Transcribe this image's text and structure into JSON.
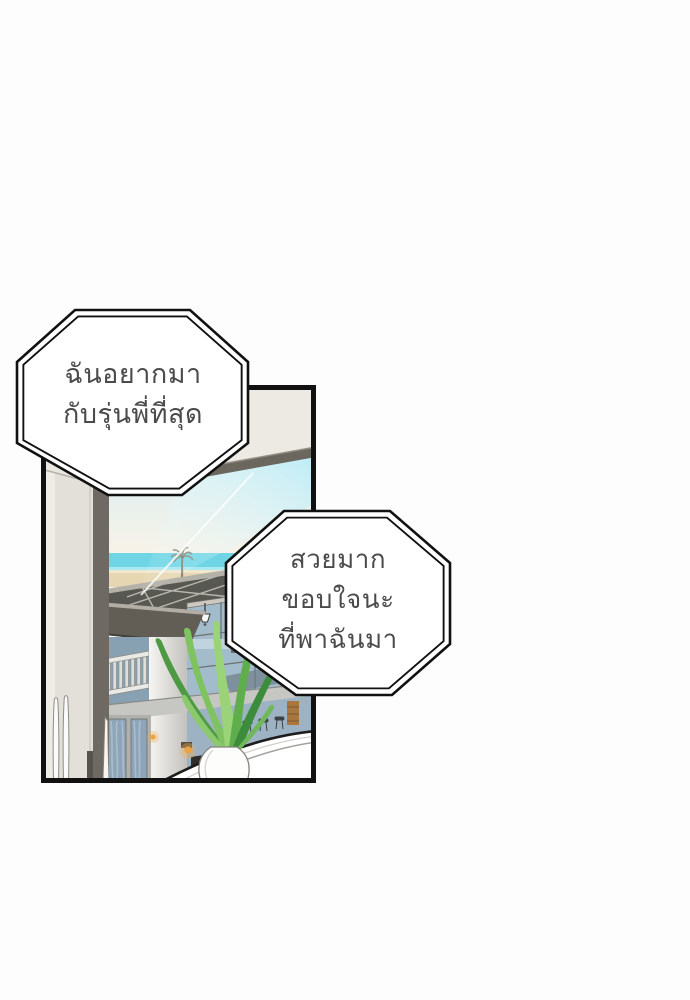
{
  "page": {
    "background": "#fdfdfd",
    "kind": "webtoon comic panel"
  },
  "bubbles": {
    "first": {
      "shape": "octagon-double-outline",
      "lines": [
        "ฉันอยากมา",
        "กับรุ่นพี่ที่สุด"
      ]
    },
    "second": {
      "shape": "octagon-double-outline",
      "lines": [
        "สวยมาก",
        "ขอบใจนะ",
        "ที่พาฉันมา"
      ]
    }
  },
  "panel": {
    "border_color": "#111111",
    "scene_elements": [
      "interior-wall-column",
      "window-beam",
      "sky",
      "sea-horizon",
      "beach-sand",
      "palm-tree",
      "glass-reflection",
      "pool-deck-panels",
      "beach-house-roof",
      "balcony-railing",
      "house-corner-column",
      "glass-wall-interior",
      "hanging-lamp",
      "curtained-windows",
      "warm-wall-lamp",
      "bar-stools",
      "shelf-strip",
      "counter-arc",
      "potted-plant",
      "white-vase",
      "decor-sticks"
    ]
  },
  "palette": {
    "panel_border": "#111111",
    "bubble_fill": "#ffffff",
    "bubble_outline": "#111111",
    "text_color": "#4b4b4b",
    "wall_cream": "#edeae3",
    "wall_grey": "#e3e0da",
    "beam_grey": "#6b675f",
    "sky_top": "#cfeef8",
    "sky_horizon": "#f7f2e8",
    "sea": "#6fd5e5",
    "sand": "#e6d7b2",
    "glass_reflection": "#aee9f6",
    "deck_dark": "#575852",
    "roof_dark": "#605c55",
    "house_glass": "#a3bccb",
    "curtain_blue": "#8fa5ba",
    "lamp_warm": "#f0a94a",
    "leaf_light": "#9bd378",
    "leaf_dark": "#3d8c3b",
    "vase_white": "#fdfdfc",
    "counter_white": "#ffffff"
  }
}
